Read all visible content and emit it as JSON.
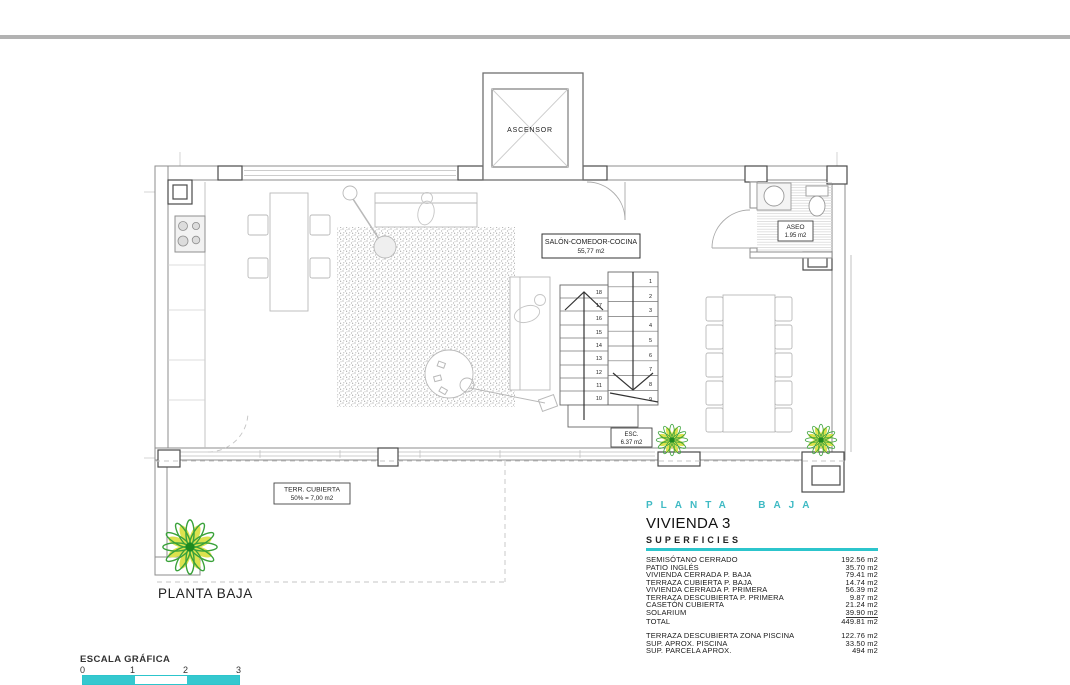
{
  "colors": {
    "teal_accent": "#2cc5cc",
    "teal_header_text": "#3fbac4",
    "top_rule_gray": "#b2b2b2",
    "wall_gray": "#8d8d8d",
    "plant_green": "#3aa23a",
    "plant_yellow": "#dce24e"
  },
  "plan": {
    "ascensor_label": "ASCENSOR",
    "salon_label": "SALÓN-COMEDOR-COCINA",
    "salon_area": "55,77 m2",
    "aseo_label": "ASEO",
    "aseo_area": "1.95 m2",
    "esc_label": "ESC.",
    "esc_area": "6.37 m2",
    "terraza_label": "TERR. CUBIERTA",
    "terraza_area": "50% = 7,00 m2",
    "floor_label": "PLANTA BAJA",
    "stairs": {
      "right": [
        "1",
        "2",
        "3",
        "4",
        "5",
        "6",
        "7",
        "8",
        "9"
      ],
      "left": [
        "18",
        "17",
        "16",
        "15",
        "14",
        "13",
        "12",
        "11",
        "10"
      ]
    }
  },
  "panel": {
    "header": "PLANTA BAJA",
    "title": "VIVIENDA 3",
    "subtitle": "SUPERFICIES",
    "rows": [
      {
        "label": "SEMISÓTANO CERRADO",
        "value": "192.56 m2"
      },
      {
        "label": "PATIO INGLÉS",
        "value": "35.70 m2"
      },
      {
        "label": "VIVIENDA CERRADA P. BAJA",
        "value": "79.41 m2"
      },
      {
        "label": "TERRAZA CUBIERTA P. BAJA",
        "value": "14.74 m2"
      },
      {
        "label": "VIVIENDA CERRADA P. PRIMERA",
        "value": "56.39 m2"
      },
      {
        "label": "TERRAZA DESCUBIERTA P. PRIMERA",
        "value": "9.87 m2"
      },
      {
        "label": "CASETÓN CUBIERTA",
        "value": "21.24 m2"
      },
      {
        "label": "SOLARIUM",
        "value": "39.90 m2"
      },
      {
        "label": "TOTAL",
        "value": "449.81 m2"
      }
    ],
    "extra_rows": [
      {
        "label": "TERRAZA DESCUBIERTA  ZONA PISCINA",
        "value": "122.76 m2"
      },
      {
        "label": "SUP.  APROX.  PISCINA",
        "value": "33.50 m2"
      },
      {
        "label": "SUP. PARCELA APROX.",
        "value": "494 m2"
      }
    ]
  },
  "scale_bar": {
    "title": "ESCALA GRÁFICA",
    "ticks": [
      "0",
      "1",
      "2",
      "3"
    ]
  }
}
